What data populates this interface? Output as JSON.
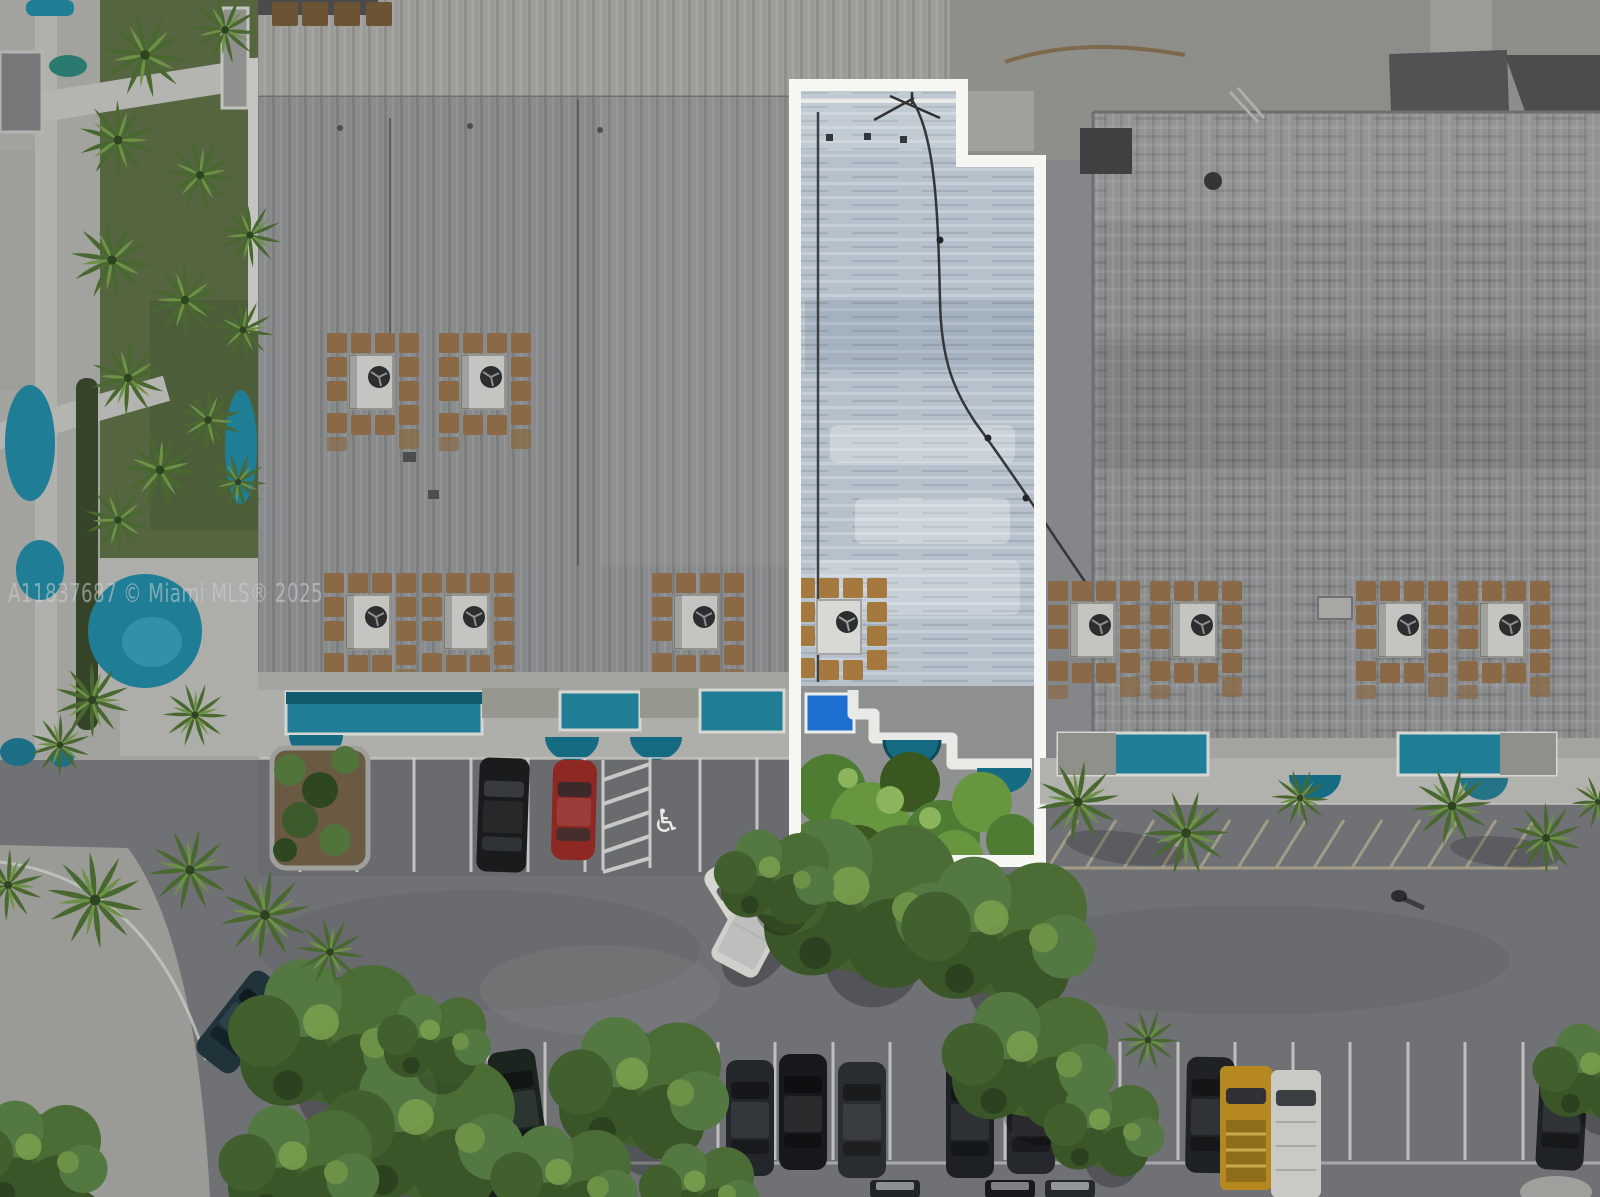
{
  "watermark": {
    "text": "A11837687 © Miami MLS® 2025"
  },
  "highlight": {
    "outline_color": "#f6f6f3"
  },
  "colors": {
    "pool_teal": "#1f7d95",
    "pool_blue": "#1d6fd0",
    "awning_teal": "#156c82",
    "paver_brown": "#8a6a46",
    "roof_grey": "#898b8d",
    "unit_roof": "#b6c1cc",
    "asphalt": "#6f7174",
    "car_red": "#8e2823",
    "truck_yellow": "#b5891f",
    "grass_green": "#546540"
  },
  "icons": {
    "handicap": "♿"
  }
}
